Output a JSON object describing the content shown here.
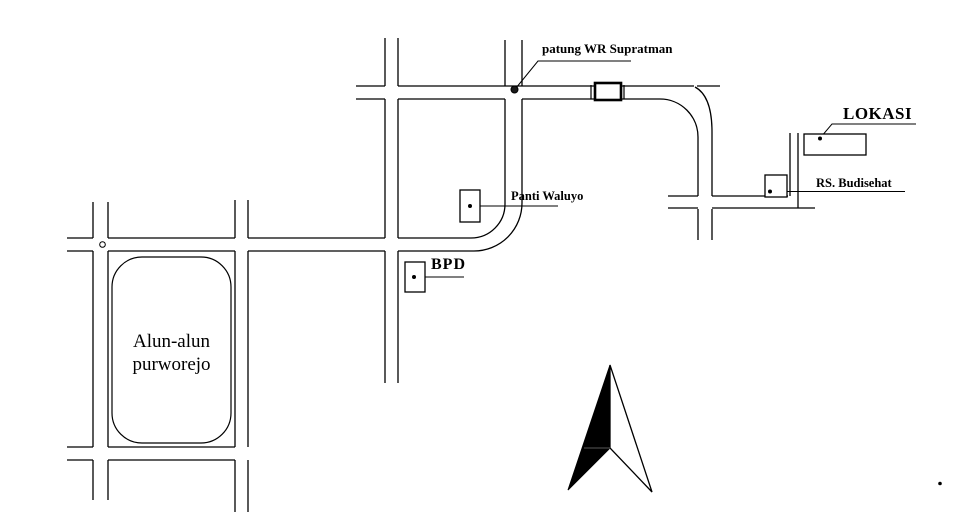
{
  "page": {
    "type": "site-location-sketch-map",
    "background_color": "#ffffff",
    "ink_color": "#000000"
  },
  "labels": {
    "statue": "patung WR Supratman",
    "location": "LOKASI",
    "hospital": "RS. Budisehat",
    "nursing_home": "Panti Waluyo",
    "bank": "BPD",
    "town_square_line1": "Alun-alun",
    "town_square_line2": "purworejo"
  },
  "icons": {
    "north_arrow": "north-arrow-icon",
    "statue_marker": "statue-marker-icon",
    "bridge": "bridge-icon",
    "intersection_circle": "intersection-circle-icon"
  }
}
